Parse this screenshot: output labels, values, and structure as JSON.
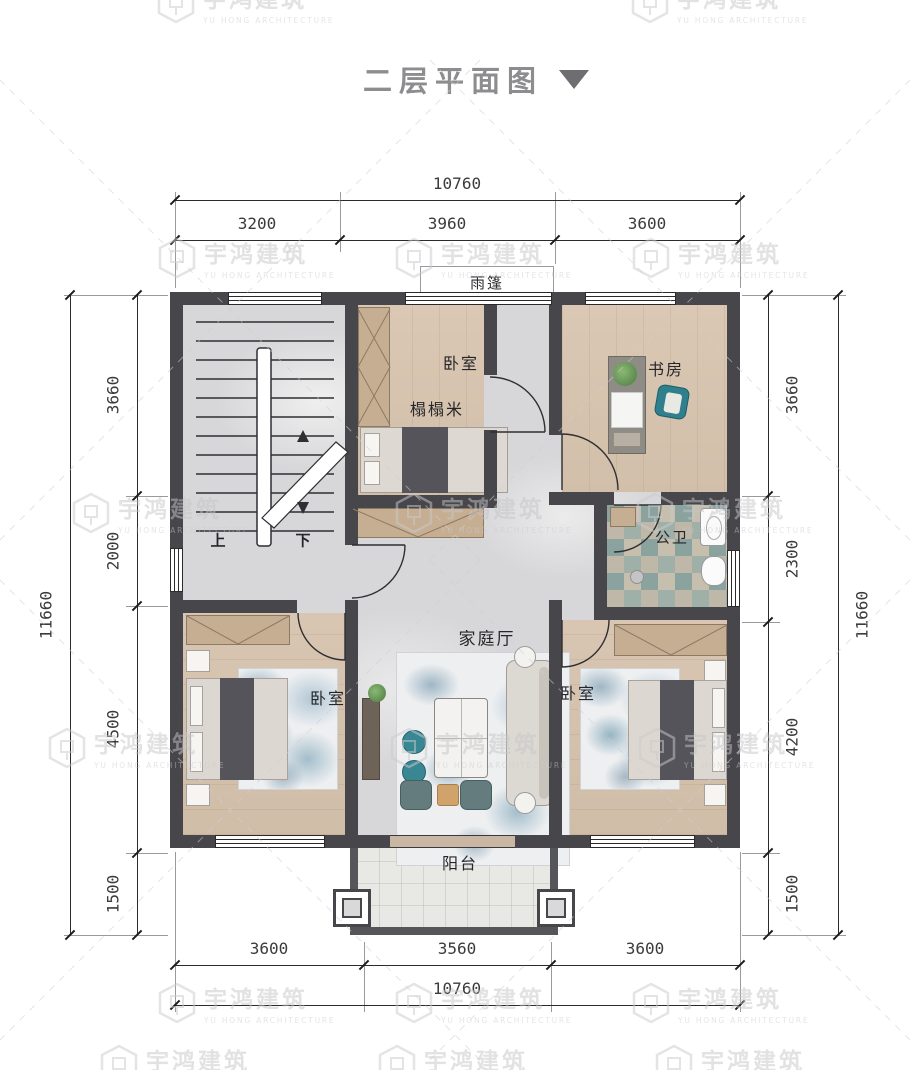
{
  "title": {
    "text": "二层平面图"
  },
  "watermark": {
    "name": "宇鸿建筑",
    "subtitle": "YU HONG ARCHITECTURE"
  },
  "dimensions": {
    "top": {
      "total": "10760",
      "segments": [
        "3200",
        "3960",
        "3600"
      ]
    },
    "bottom": {
      "total": "10760",
      "segments": [
        "3600",
        "3560",
        "3600"
      ]
    },
    "left": {
      "total": "11660",
      "segments": [
        "3660",
        "2000",
        "4500",
        "1500"
      ]
    },
    "right": {
      "total": "11660",
      "segments": [
        "3660",
        "2300",
        "4200",
        "1500"
      ]
    }
  },
  "labels": {
    "canopy": "雨篷",
    "bedroom_top": "卧室",
    "tatami": "榻榻米",
    "study": "书房",
    "bathroom": "公卫",
    "family_hall": "家庭厅",
    "bedroom_left": "卧室",
    "bedroom_right": "卧室",
    "balcony": "阳台",
    "stair_up": "上",
    "stair_down": "下"
  },
  "colors": {
    "wall": "#47474b",
    "wood_floor": "#d8c6b2",
    "marble_floor": "#d7d7d9",
    "tile_accent": "#8ba39e",
    "teal_accent": "#2f7f8d",
    "rug_blue": "#5d87a0",
    "title_gray": "#8d8d8f",
    "watermark_gray": "#c6c6c9",
    "dimension_text": "#3b3b3b"
  }
}
